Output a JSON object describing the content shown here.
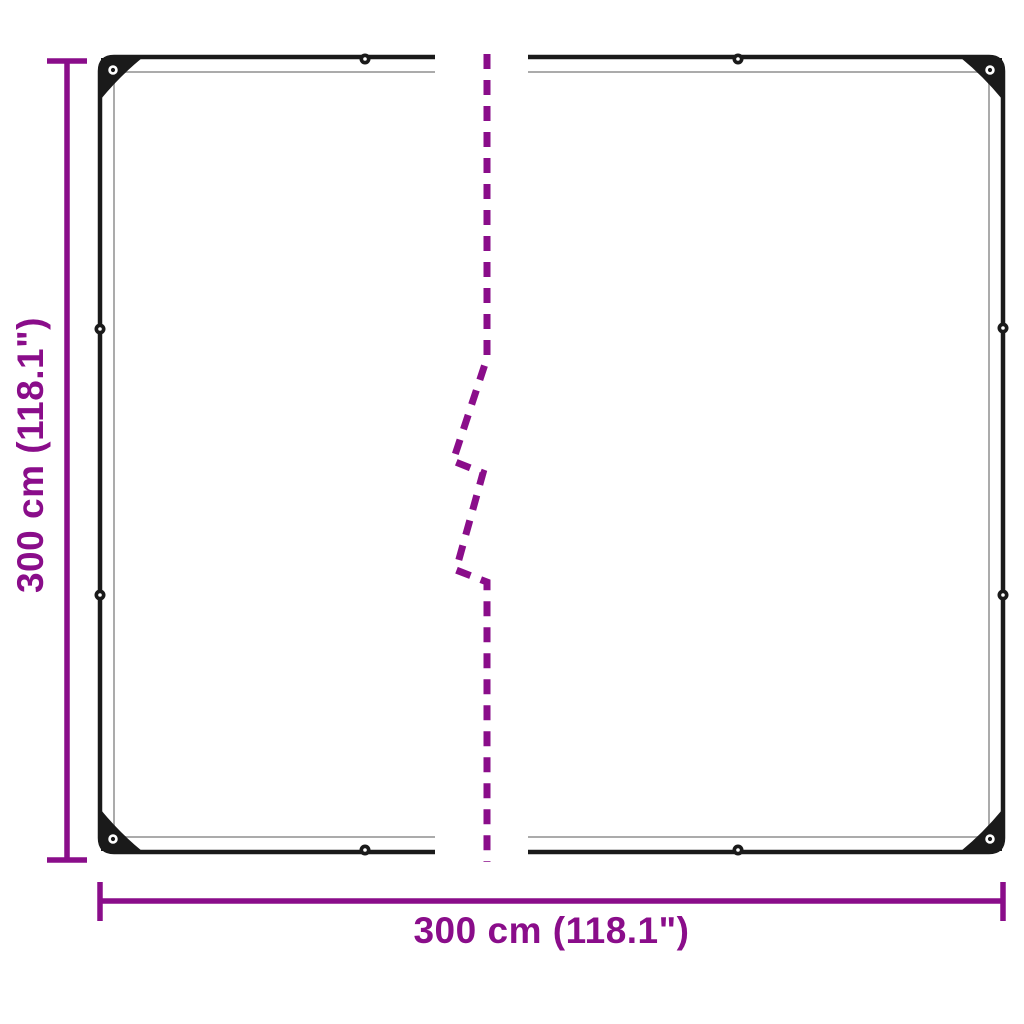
{
  "diagram": {
    "background_color": "#ffffff",
    "accent_color": "#8A0D8A",
    "outline_color": "#1A1A1A",
    "inner_seam_color": "#ABABAB",
    "eyelet_hole_color": "#ffffff",
    "vertical_dimension": {
      "label": "300 cm (118.1\")"
    },
    "horizontal_dimension": {
      "label": "300 cm (118.1\")"
    }
  }
}
